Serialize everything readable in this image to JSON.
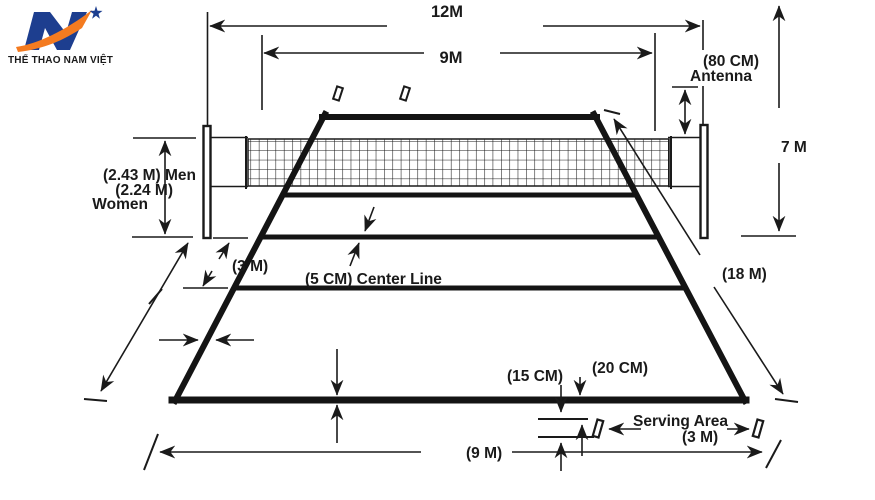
{
  "logo": {
    "text": "THỂ THAO NAM VIỆT",
    "colors": {
      "blue": "#1d3e8f",
      "orange": "#f47b20",
      "red_text": "#e8401c"
    }
  },
  "labels": {
    "total_width": "12M",
    "court_width": "9M",
    "antenna_height": "(80 CM)",
    "antenna": "Antenna",
    "free_height": "7 M",
    "net_height_men": "(2.43 M) Men",
    "net_height_women_value": "(2.24 M)",
    "net_height_women": "Women",
    "attack_line_distance": "(3 M)",
    "center_line": "(5 CM) Center Line",
    "court_length": "(18 M)",
    "serving_mark_length": "(15 CM)",
    "serving_mark_offset": "(20 CM)",
    "serving_area": "Serving Area",
    "serving_area_width": "(3 M)",
    "half_court_length": "(9 M)"
  },
  "diagram": {
    "ink": "#1a1a1a",
    "background": "#ffffff"
  }
}
